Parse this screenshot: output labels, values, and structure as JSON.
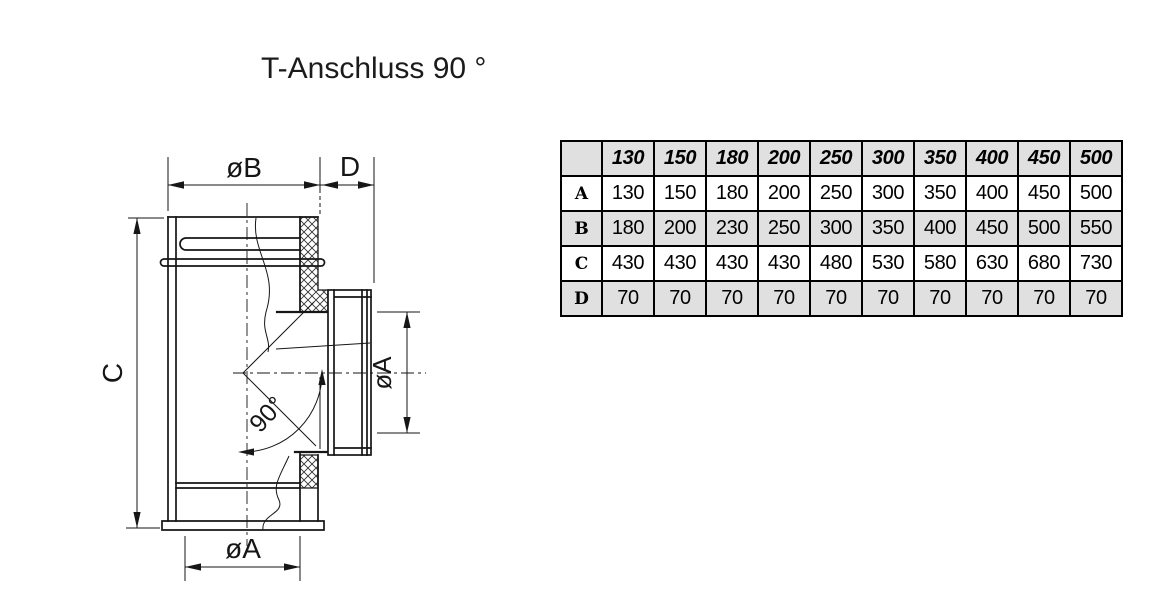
{
  "title": "T-Anschluss 90 °",
  "colors": {
    "table_band": "#e0e0e0",
    "line": "#161616",
    "background": "#ffffff"
  },
  "drawing": {
    "labels": {
      "dim_outer_width": "øB",
      "dim_branch_offset": "D",
      "dim_height": "C",
      "dim_branch_diameter": "øA",
      "dim_bottom_diameter": "øA",
      "angle": "90°"
    }
  },
  "table": {
    "corner": "",
    "columns": [
      "130",
      "150",
      "180",
      "200",
      "250",
      "300",
      "350",
      "400",
      "450",
      "500"
    ],
    "rows": [
      {
        "label": "A",
        "values": [
          "130",
          "150",
          "180",
          "200",
          "250",
          "300",
          "350",
          "400",
          "450",
          "500"
        ]
      },
      {
        "label": "B",
        "values": [
          "180",
          "200",
          "230",
          "250",
          "300",
          "350",
          "400",
          "450",
          "500",
          "550"
        ]
      },
      {
        "label": "C",
        "values": [
          "430",
          "430",
          "430",
          "430",
          "480",
          "530",
          "580",
          "630",
          "680",
          "730"
        ]
      },
      {
        "label": "D",
        "values": [
          "70",
          "70",
          "70",
          "70",
          "70",
          "70",
          "70",
          "70",
          "70",
          "70"
        ]
      }
    ]
  }
}
